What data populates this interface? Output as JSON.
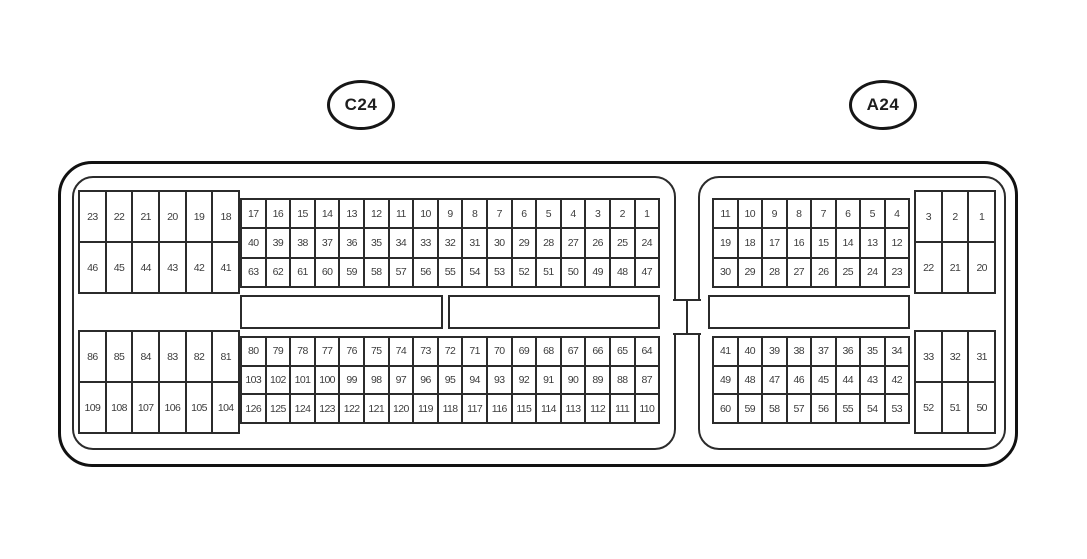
{
  "diagram": {
    "type": "connector-pinout",
    "line_color": "#2b2b2b",
    "background": "#ffffff"
  },
  "connectors": {
    "c24": {
      "label": "C24",
      "total_pins": 126,
      "blocks": {
        "top_side": {
          "rows": [
            [
              "23",
              "22",
              "21",
              "20",
              "19",
              "18"
            ],
            [
              "46",
              "45",
              "44",
              "43",
              "42",
              "41"
            ]
          ]
        },
        "top_main": {
          "rows": [
            [
              "17",
              "16",
              "15",
              "14",
              "13",
              "12",
              "11",
              "10",
              "9",
              "8",
              "7",
              "6",
              "5",
              "4",
              "3",
              "2",
              "1"
            ],
            [
              "40",
              "39",
              "38",
              "37",
              "36",
              "35",
              "34",
              "33",
              "32",
              "31",
              "30",
              "29",
              "28",
              "27",
              "26",
              "25",
              "24"
            ],
            [
              "63",
              "62",
              "61",
              "60",
              "59",
              "58",
              "57",
              "56",
              "55",
              "54",
              "53",
              "52",
              "51",
              "50",
              "49",
              "48",
              "47"
            ]
          ]
        },
        "bottom_side": {
          "rows": [
            [
              "86",
              "85",
              "84",
              "83",
              "82",
              "81"
            ],
            [
              "109",
              "108",
              "107",
              "106",
              "105",
              "104"
            ]
          ]
        },
        "bottom_main": {
          "rows": [
            [
              "80",
              "79",
              "78",
              "77",
              "76",
              "75",
              "74",
              "73",
              "72",
              "71",
              "70",
              "69",
              "68",
              "67",
              "66",
              "65",
              "64"
            ],
            [
              "103",
              "102",
              "101",
              "100",
              "99",
              "98",
              "97",
              "96",
              "95",
              "94",
              "93",
              "92",
              "91",
              "90",
              "89",
              "88",
              "87"
            ],
            [
              "126",
              "125",
              "124",
              "123",
              "122",
              "121",
              "120",
              "119",
              "118",
              "117",
              "116",
              "115",
              "114",
              "113",
              "112",
              "111",
              "110"
            ]
          ]
        },
        "keyway_slots": 2
      }
    },
    "a24": {
      "label": "A24",
      "total_pins": 60,
      "blocks": {
        "top_main": {
          "rows": [
            [
              "11",
              "10",
              "9",
              "8",
              "7",
              "6",
              "5",
              "4"
            ],
            [
              "19",
              "18",
              "17",
              "16",
              "15",
              "14",
              "13",
              "12"
            ],
            [
              "30",
              "29",
              "28",
              "27",
              "26",
              "25",
              "24",
              "23"
            ]
          ]
        },
        "top_side": {
          "rows": [
            [
              "3",
              "2",
              "1"
            ],
            [
              "22",
              "21",
              "20"
            ]
          ]
        },
        "bottom_main": {
          "rows": [
            [
              "41",
              "40",
              "39",
              "38",
              "37",
              "36",
              "35",
              "34"
            ],
            [
              "49",
              "48",
              "47",
              "46",
              "45",
              "44",
              "43",
              "42"
            ],
            [
              "60",
              "59",
              "58",
              "57",
              "56",
              "55",
              "54",
              "53"
            ]
          ]
        },
        "bottom_side": {
          "rows": [
            [
              "33",
              "32",
              "31"
            ],
            [
              "52",
              "51",
              "50"
            ]
          ]
        },
        "keyway_slots": 1
      }
    }
  }
}
